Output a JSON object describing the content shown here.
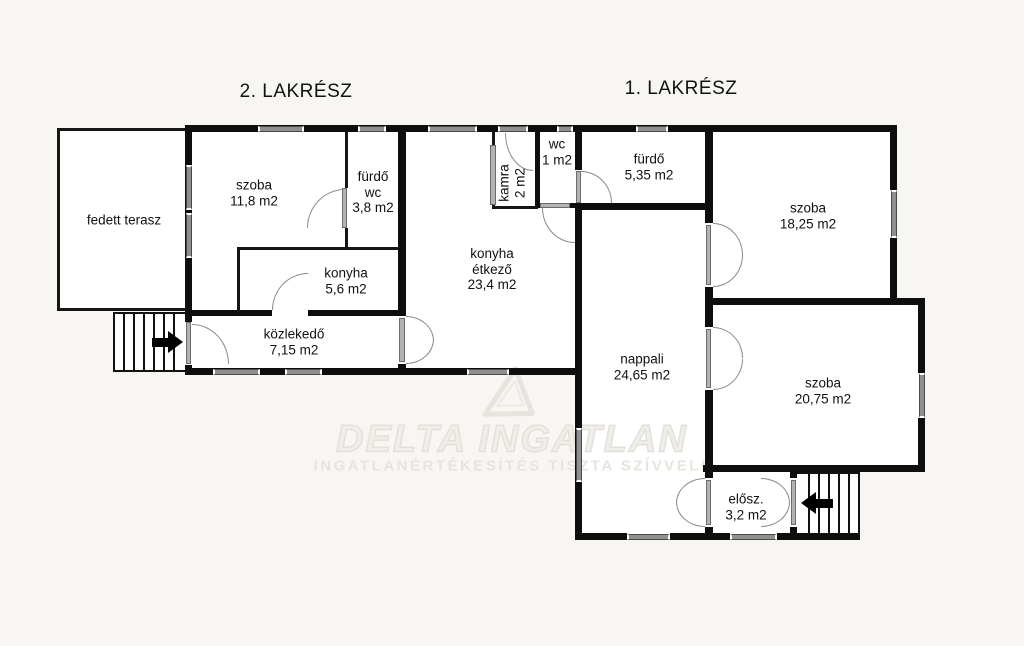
{
  "titles": {
    "section_left": "2. LAKRÉSZ",
    "section_right": "1. LAKRÉSZ"
  },
  "rooms": [
    {
      "id": "fedett-terasz",
      "lines": [
        "fedett terasz"
      ]
    },
    {
      "id": "szoba-2lakresz",
      "lines": [
        "szoba",
        "11,8 m2"
      ]
    },
    {
      "id": "furdo-wc",
      "lines": [
        "fürdő",
        "wc",
        "3,8 m2"
      ]
    },
    {
      "id": "konyha-2lakresz",
      "lines": [
        "konyha",
        "5,6 m2"
      ]
    },
    {
      "id": "kozlekedo",
      "lines": [
        "közlekedő",
        "7,15 m2"
      ]
    },
    {
      "id": "kamra",
      "lines": [
        "kamra",
        "2 m2"
      ]
    },
    {
      "id": "wc",
      "lines": [
        "wc",
        "1 m2"
      ]
    },
    {
      "id": "konyha-etkezo",
      "lines": [
        "konyha",
        "étkező",
        "23,4 m2"
      ]
    },
    {
      "id": "furdo-1lakresz",
      "lines": [
        "fürdő",
        "5,35 m2"
      ]
    },
    {
      "id": "szoba-1a",
      "lines": [
        "szoba",
        "18,25 m2"
      ]
    },
    {
      "id": "nappali",
      "lines": [
        "nappali",
        "24,65 m2"
      ]
    },
    {
      "id": "szoba-1b",
      "lines": [
        "szoba",
        "20,75 m2"
      ]
    },
    {
      "id": "eloszoba",
      "lines": [
        "elősz.",
        "3,2 m2"
      ]
    }
  ],
  "watermark": {
    "line1": "DELTA INGATLAN",
    "line2": "INGATLANÉRTÉKESÍTÉS TISZTA SZÍVVEL!"
  },
  "colors": {
    "background": "#f7f6f3",
    "wall": "#0e0e0e",
    "window": "#8f8f8f",
    "watermark": "#e6e3dd"
  }
}
